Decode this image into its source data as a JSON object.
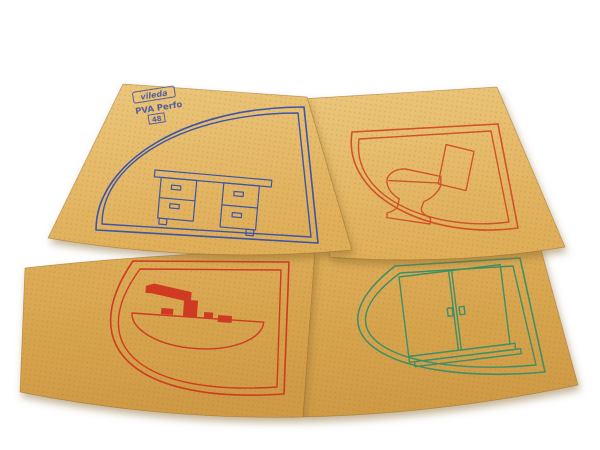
{
  "scene": {
    "background_color": "#ffffff",
    "subject": "Four overlapping tan PVA sponge cloths, each printed with a colored double quarter-circle frame and a furniture pictogram"
  },
  "stamp": {
    "brand": "vileda",
    "product_line": "PVA Perfo",
    "size_code": "48",
    "ink_color": "#3b4ea6"
  },
  "cloth_style": {
    "light_color": "#ecc77d",
    "base_color": "#dfae58",
    "dark_color": "#cf9a45",
    "perforation_dot_color": "rgba(146,98,30,0.26)",
    "shadow_color": "#8a6a33"
  },
  "cloths": [
    {
      "position": "top-left",
      "pictogram": "desk",
      "print_color": "#3c55a8"
    },
    {
      "position": "top-right",
      "pictogram": "toilet",
      "print_color": "#d0512b"
    },
    {
      "position": "bottom-left",
      "pictogram": "washbasin",
      "print_color": "#cf3a22"
    },
    {
      "position": "bottom-right",
      "pictogram": "cabinet",
      "print_color": "#3f8f66"
    }
  ]
}
